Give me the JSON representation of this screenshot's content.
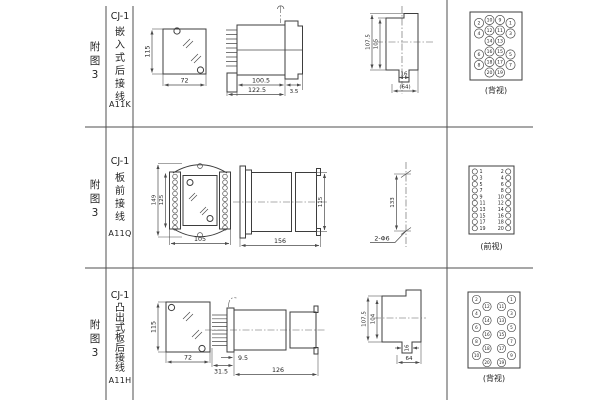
{
  "rows": [
    {
      "fig": "附图3",
      "model": "CJ-1",
      "mount": "嵌入式后接线",
      "code": "A11K",
      "front": {
        "height": "115",
        "width": "72"
      },
      "side": {
        "body_len": "100.5",
        "total_len": "122.5",
        "flange": "3.5"
      },
      "cutout": {
        "outer_h": "107.5",
        "inner_h": "105",
        "stub_w": "16",
        "width": "(64)"
      },
      "terminal": {
        "caption": "(背视)",
        "numbers": [
          "2",
          "10",
          "9",
          "1",
          "4",
          "12",
          "11",
          "3",
          "14",
          "13",
          "6",
          "16",
          "15",
          "5",
          "8",
          "18",
          "17",
          "7",
          "20",
          "19"
        ]
      }
    },
    {
      "fig": "附图3",
      "model": "CJ-1",
      "mount": "板前接线",
      "code": "A11Q",
      "front": {
        "outer_h": "149",
        "inner_h": "125",
        "width": "105"
      },
      "side": {
        "total_len": "156",
        "height": "115"
      },
      "drill": {
        "pitch": "133",
        "holes": "2-Φ6"
      },
      "terminal": {
        "caption": "(前视)",
        "left_numbers": [
          "1",
          "3",
          "5",
          "7",
          "9",
          "11",
          "13",
          "15",
          "17",
          "19"
        ],
        "right_numbers": [
          "2",
          "4",
          "6",
          "8",
          "10",
          "12",
          "14",
          "16",
          "18",
          "20"
        ]
      }
    },
    {
      "fig": "附图3",
      "model": "CJ-1",
      "mount": "凸出式板后接线",
      "code": "A11H",
      "front": {
        "height": "115",
        "width": "72"
      },
      "side": {
        "pin_len": "31.5",
        "offset": "9.5",
        "body_len": "126"
      },
      "cutout": {
        "outer_h": "107.5",
        "inner_h": "104",
        "stub_w": "16",
        "width": "64"
      },
      "terminal": {
        "caption": "(背视)",
        "outer_left": [
          "2",
          "4",
          "6",
          "8",
          "10"
        ],
        "inner_left": [
          "12",
          "14",
          "16",
          "18",
          "20"
        ],
        "inner_right": [
          "11",
          "13",
          "15",
          "17",
          "19"
        ],
        "outer_right": [
          "1",
          "3",
          "5",
          "7",
          "9"
        ]
      }
    }
  ]
}
